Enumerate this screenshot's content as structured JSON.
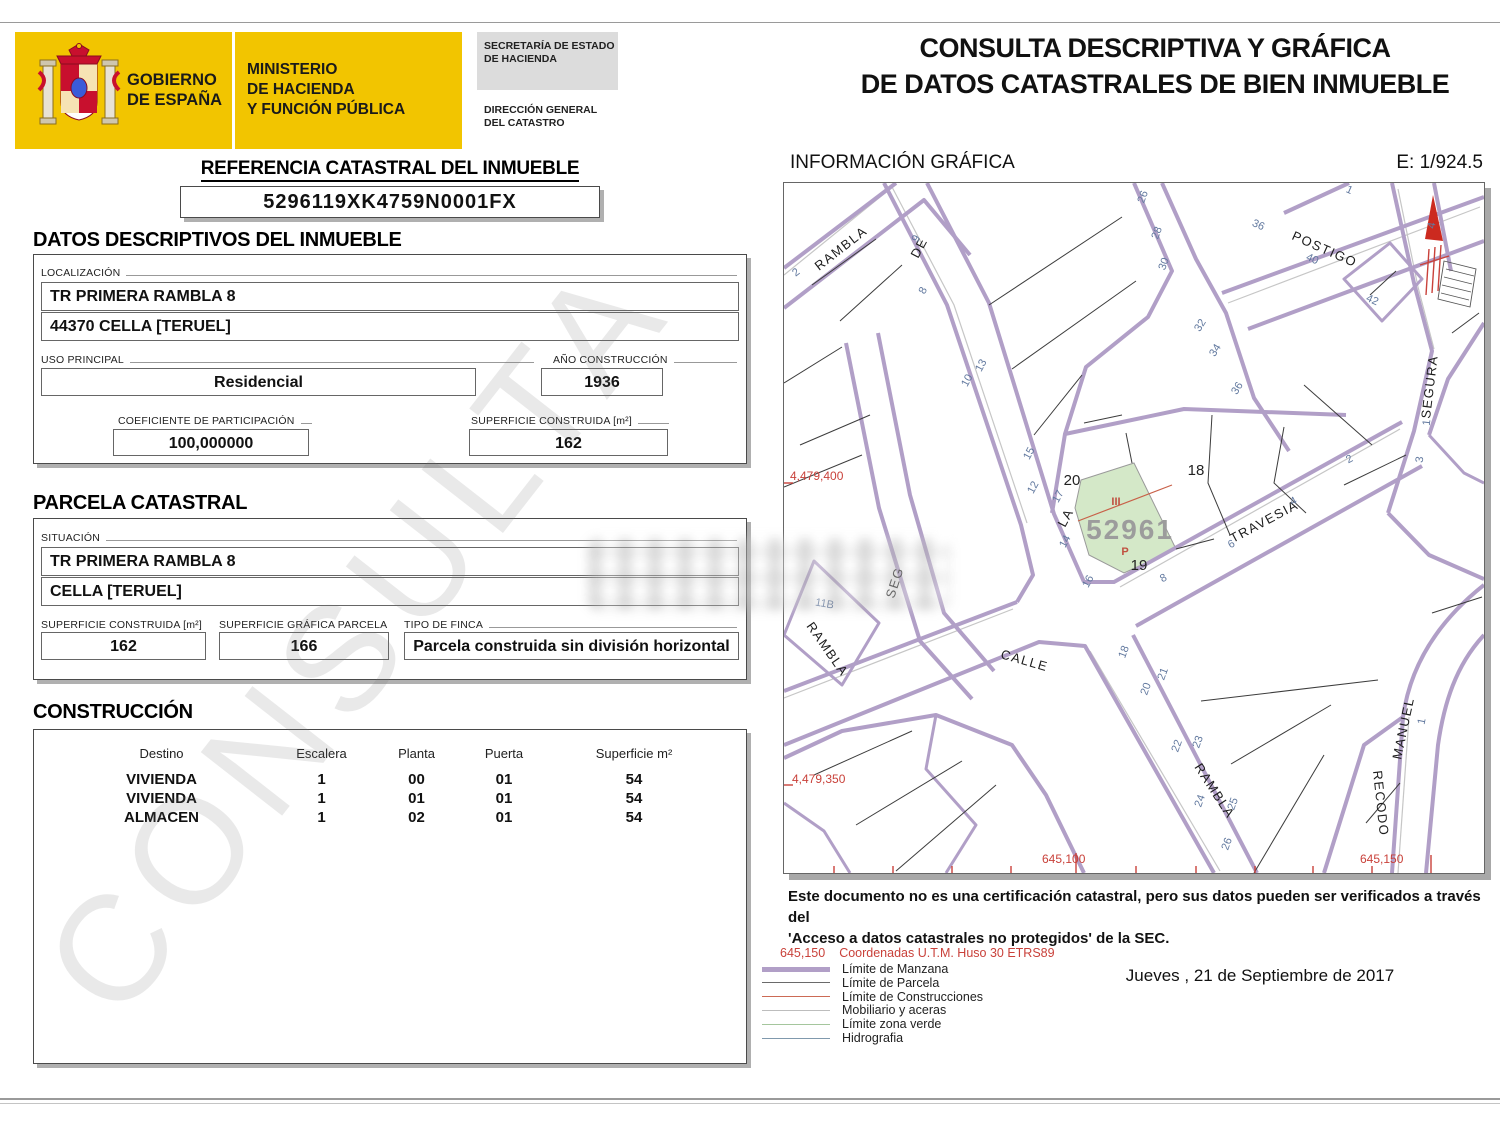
{
  "watermark": "CONSULTA",
  "header": {
    "government_line1": "GOBIERNO",
    "government_line2": "DE ESPAÑA",
    "ministry_line1": "MINISTERIO",
    "ministry_line2": "DE HACIENDA",
    "ministry_line3": "Y FUNCIÓN PÚBLICA",
    "secretaria_line1": "SECRETARÍA DE ESTADO",
    "secretaria_line2": "DE HACIENDA",
    "direccion_line1": "DIRECCIÓN GENERAL",
    "direccion_line2": "DEL CATASTRO",
    "title_line1": "CONSULTA DESCRIPTIVA Y GRÁFICA",
    "title_line2": "DE DATOS CATASTRALES DE BIEN INMUEBLE"
  },
  "reference": {
    "heading": "REFERENCIA CATASTRAL DEL INMUEBLE",
    "value": "5296119XK4759N0001FX"
  },
  "descriptive": {
    "heading": "DATOS DESCRIPTIVOS DEL INMUEBLE",
    "localizacion_label": "LOCALIZACIÓN",
    "localizacion_line1": "TR PRIMERA RAMBLA 8",
    "localizacion_line2": "44370 CELLA [TERUEL]",
    "uso_label": "USO PRINCIPAL",
    "uso_value": "Residencial",
    "ano_label": "AÑO CONSTRUCCIÓN",
    "ano_value": "1936",
    "coef_label": "COEFICIENTE DE PARTICIPACIÓN",
    "coef_value": "100,000000",
    "superficie_label": "SUPERFICIE CONSTRUIDA [m²]",
    "superficie_value": "162"
  },
  "parcela": {
    "heading": "PARCELA CATASTRAL",
    "situacion_label": "SITUACIÓN",
    "situacion_line1": "TR PRIMERA RAMBLA 8",
    "situacion_line2": "CELLA [TERUEL]",
    "sup_construida_label": "SUPERFICIE CONSTRUIDA [m²]",
    "sup_construida_value": "162",
    "sup_grafica_label": "SUPERFICIE GRÁFICA PARCELA [m²]",
    "sup_grafica_value": "166",
    "tipo_label": "TIPO DE FINCA",
    "tipo_value": "Parcela construida sin división horizontal"
  },
  "construccion": {
    "heading": "CONSTRUCCIÓN",
    "columns": [
      "Destino",
      "Escalera",
      "Planta",
      "Puerta",
      "Superficie m²"
    ],
    "rows": [
      [
        "VIVIENDA",
        "1",
        "00",
        "01",
        "54"
      ],
      [
        "VIVIENDA",
        "1",
        "01",
        "01",
        "54"
      ],
      [
        "ALMACEN",
        "1",
        "02",
        "01",
        "54"
      ]
    ]
  },
  "grafica": {
    "heading": "INFORMACIÓN GRÁFICA",
    "scale": "E: 1/924.5",
    "subject_parcel": {
      "number": "52961",
      "construction_mark": "III",
      "portal_mark": "P",
      "parcel": "19"
    },
    "parcel_labels": [
      {
        "t": "20",
        "x": 288,
        "y": 302
      },
      {
        "t": "18",
        "x": 412,
        "y": 292
      },
      {
        "t": "19",
        "x": 355,
        "y": 387
      }
    ],
    "street_labels": [
      {
        "t": "RAMBLA",
        "x": 35,
        "y": 88,
        "r": -38
      },
      {
        "t": "DE",
        "x": 134,
        "y": 76,
        "r": -62
      },
      {
        "t": "POSTIGO",
        "x": 507,
        "y": 56,
        "r": 24
      },
      {
        "t": "TRAVESIA",
        "x": 449,
        "y": 360,
        "r": -28
      },
      {
        "t": "LA",
        "x": 281,
        "y": 345,
        "r": -62
      },
      {
        "t": "SEGURA",
        "x": 646,
        "y": 236,
        "r": -83
      },
      {
        "t": "SEG",
        "x": 110,
        "y": 416,
        "r": -72
      },
      {
        "t": "CALLE",
        "x": 216,
        "y": 475,
        "r": 16
      },
      {
        "t": "RAMBLA",
        "x": 22,
        "y": 443,
        "r": 55
      },
      {
        "t": "RAMBLA",
        "x": 410,
        "y": 584,
        "r": 57
      },
      {
        "t": "MANUEL",
        "x": 617,
        "y": 577,
        "r": -78
      },
      {
        "t": "RECODO",
        "x": 589,
        "y": 588,
        "r": 84
      }
    ],
    "house_numbers": [
      {
        "t": "2",
        "x": 14,
        "y": 92,
        "r": -38
      },
      {
        "t": "9",
        "x": 135,
        "y": 57,
        "r": -62
      },
      {
        "t": "8",
        "x": 142,
        "y": 109,
        "r": -62
      },
      {
        "t": "13",
        "x": 200,
        "y": 184,
        "r": -62
      },
      {
        "t": "10",
        "x": 186,
        "y": 199,
        "r": -62
      },
      {
        "t": "15",
        "x": 248,
        "y": 272,
        "r": -62
      },
      {
        "t": "12",
        "x": 252,
        "y": 306,
        "r": -62
      },
      {
        "t": "17",
        "x": 277,
        "y": 315,
        "r": -62
      },
      {
        "t": "14",
        "x": 284,
        "y": 360,
        "r": -62
      },
      {
        "t": "16",
        "x": 307,
        "y": 400,
        "r": -62
      },
      {
        "t": "26",
        "x": 362,
        "y": 15,
        "r": -70
      },
      {
        "t": "28",
        "x": 376,
        "y": 51,
        "r": -70
      },
      {
        "t": "30",
        "x": 383,
        "y": 82,
        "r": -70
      },
      {
        "t": "32",
        "x": 419,
        "y": 144,
        "r": -58
      },
      {
        "t": "34",
        "x": 434,
        "y": 169,
        "r": -58
      },
      {
        "t": "36",
        "x": 456,
        "y": 207,
        "r": -58
      },
      {
        "t": "36",
        "x": 473,
        "y": 45,
        "r": 24
      },
      {
        "t": "40",
        "x": 527,
        "y": 79,
        "r": 24
      },
      {
        "t": "42",
        "x": 587,
        "y": 120,
        "r": 24
      },
      {
        "t": "1",
        "x": 564,
        "y": 10,
        "r": 24
      },
      {
        "t": "2",
        "x": 567,
        "y": 279,
        "r": -28
      },
      {
        "t": "4",
        "x": 511,
        "y": 321,
        "r": -28
      },
      {
        "t": "6",
        "x": 449,
        "y": 364,
        "r": -28
      },
      {
        "t": "8",
        "x": 381,
        "y": 398,
        "r": -28
      },
      {
        "t": "4",
        "x": 651,
        "y": 43,
        "r": -80
      },
      {
        "t": "1",
        "x": 646,
        "y": 240,
        "r": -83
      },
      {
        "t": "3",
        "x": 639,
        "y": 277,
        "r": -83
      },
      {
        "t": "18",
        "x": 343,
        "y": 470,
        "r": -70
      },
      {
        "t": "20",
        "x": 365,
        "y": 507,
        "r": -70
      },
      {
        "t": "21",
        "x": 382,
        "y": 492,
        "r": -70
      },
      {
        "t": "22",
        "x": 396,
        "y": 564,
        "r": -70
      },
      {
        "t": "23",
        "x": 417,
        "y": 560,
        "r": -70
      },
      {
        "t": "24",
        "x": 419,
        "y": 619,
        "r": -70
      },
      {
        "t": "25",
        "x": 452,
        "y": 622,
        "r": -70
      },
      {
        "t": "26",
        "x": 446,
        "y": 662,
        "r": -70
      },
      {
        "t": "1",
        "x": 641,
        "y": 539,
        "r": -78
      },
      {
        "t": "11B",
        "x": 40,
        "y": 424,
        "r": 10
      }
    ],
    "utm_labels": [
      {
        "t": "4,479,400",
        "x": 6,
        "y": 297
      },
      {
        "t": "4,479,350",
        "x": 8,
        "y": 600
      },
      {
        "t": "645,100",
        "x": 258,
        "y": 680
      },
      {
        "t": "645,150",
        "x": 576,
        "y": 680
      }
    ]
  },
  "footer": {
    "disclaimer_line1": "Este documento no es una certificación catastral, pero sus datos pueden ser verificados a través del",
    "disclaimer_line2": "'Acceso a datos catastrales no protegidos' de la SEC.",
    "date": "Jueves , 21 de Septiembre de 2017"
  },
  "legend": {
    "coord_sample": "645,150",
    "coord_label": "Coordenadas U.T.M. Huso 30 ETRS89",
    "items": [
      {
        "label": "Límite de Manzana",
        "color": "#b19fc7",
        "weight": 5
      },
      {
        "label": "Límite de Parcela",
        "color": "#6a6a6a",
        "weight": 1.5
      },
      {
        "label": "Límite de Construcciones",
        "color": "#cc6a55",
        "weight": 1.5
      },
      {
        "label": "Mobiliario y aceras",
        "color": "#bdbdbd",
        "weight": 1.5
      },
      {
        "label": "Límite zona verde",
        "color": "#a5c69d",
        "weight": 1.5
      },
      {
        "label": "Hidrografia",
        "color": "#8099ad",
        "weight": 1.5
      }
    ]
  },
  "colors": {
    "banner_yellow": "#f2c500",
    "manzana_purple": "#b19fc7",
    "utm_red": "#c9413a",
    "house_number_blue": "#62799f",
    "subject_green": "#d4e8c8"
  }
}
